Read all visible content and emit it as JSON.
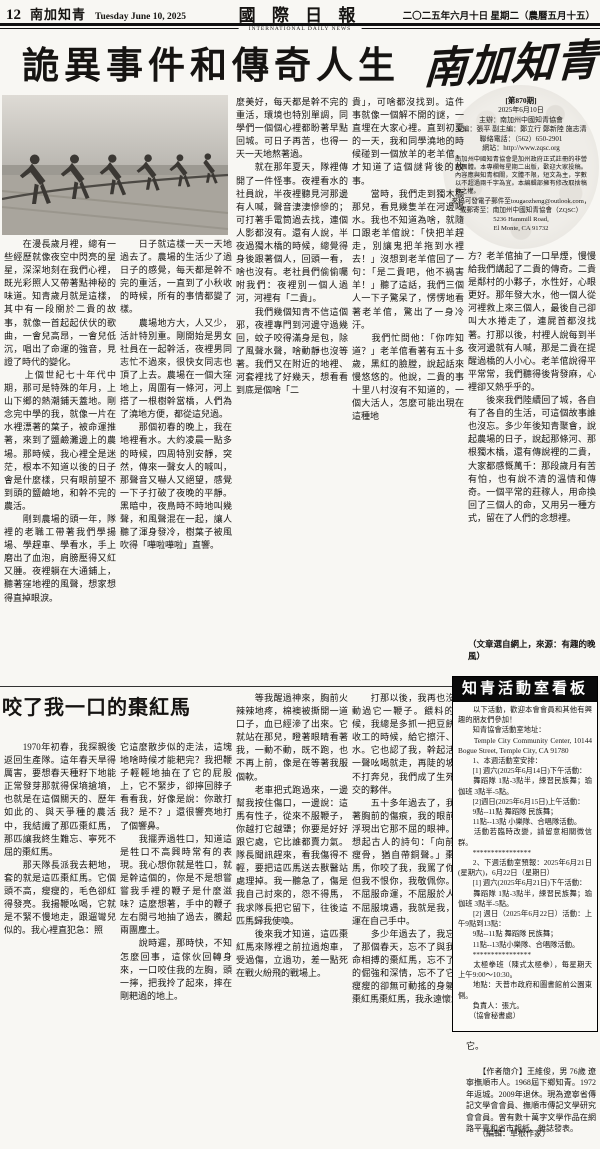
{
  "colors": {
    "ink": "#161412",
    "paper": "#f8f7f3",
    "bar": "#0a0a0a"
  },
  "header": {
    "page_number": "12",
    "section": "南加知青",
    "date_en": "Tuesday June 10, 2025",
    "paper_name": "國 際 日 報",
    "paper_sub": "INTERNATIONAL DAILY NEWS",
    "date_zh": "二〇二五年六月十日 星期二（農曆五月十五）"
  },
  "masthead": {
    "title": "南加知青"
  },
  "info_box": {
    "issue": "[第870期]",
    "date": "2025年6月10日",
    "host": "主辦：南加州中國知青協會",
    "editors": "主編：張平 副主編：鄭立行 鄭新陸 施志清",
    "phone": "聯絡電話：（562）650-2901",
    "site": "網站：http://www.zqsc.org",
    "notice": "南加州中國知青協會是加州政府正式註冊的非營利團體。本專欄每星期二出版，歡迎大家投稿。內容應與知青相關，文體不限，短文為主，字數以不超過兩千字為宜。本編輯部擁有修改取捨稿件之權。",
    "submit": "來稿可發電子郵件至tougaozheng@outlook.com，",
    "mail": "或郵寄至：南加州中國知青協會（ZQSC）",
    "addr1": "5236 Hammill Road,",
    "addr2": "El Monte,  CA 91732"
  },
  "main_article": {
    "title": "詭異事件和傳奇人生",
    "col1": "　　在漫長歲月裡，總有一些經歷就像夜空中閃亮的星星，深深地刻在我們心裡，既光彩照人又帶著點神秘的味道。知青歲月就是這樣，其中有一段關於二貴的故事，就像一首起起伏伏的歌曲，一會兒高昂，一會兒低沉，唱出了命運的強音，見證了時代的變化。\n　　上個世紀七十年代中期，那可是特殊的年月，上山下鄉的熱潮鋪天蓋地。剛念完中學的我，就像一片在水裡漂著的葉子，被命運推著，來到了鹽鹼灘邊上的農場。那時候，我心裡全是迷茫，根本不知道以後的日子會是什麼樣，只有眼前望不到頭的鹽鹼地，和幹不完的農活。\n　　剛到農場的頭一年，隊裡的老職工帶著我們學揚場、學趕車、學看水，手上磨出了血泡，肩膀壓得又紅又腫。夜裡躺在大通鋪上，聽著窪地裡的風聲，想家想得直掉眼淚。",
    "col2": "　　日子就這樣一天一天地過去了。農場的生活少了過日子的感覺，每天都是幹不完的重活，一直到了小秋收的時候，所有的事情都變了樣。\n　　農場地方大，人又少，活計特別重。剛開始是男女社員在一起幹活，夜裡男同志忙不過來，很快女同志也頂了上去。農場在一個大窪地上，周圍有一條河，河上搭了一根樹幹當橋，人們為了澆地方便，都從這兒過。\n　　那個初春的晚上，我在地裡看水。大約凌晨一點多的時候，四周特別安靜，突然，傳來一聲女人的喊叫，那聲音又嚇人又絕望，感覺一下子打破了夜晚的平靜。黑暗中，夜鳥時不時地叫幾聲，和風聲混在一起，讓人聽了渾身發冷，樹葉子被風吹得「嘩啦嘩啦」直響。",
    "col3": "麼美好，每天都是幹不完的重活，環境也特別單調，同學們一個個心裡都盼著早點回城。可日子再苦，也得一天一天地熬著過。\n　　就在那年夏天，隊裡傳開了一件怪事。夜裡看水的社員說，半夜裡聽見河那邊有人喊，聲音淒淒慘慘的；可打著手電筒過去找，連個人影都沒有。還有人說，半夜過獨木橋的時候，總覺得身後跟著個人，回頭一看，啥也沒有。老社員們偷偷囑咐我們：夜裡別一個人過河，河裡有「二貴」。\n　　我們幾個知青不信這個邪，夜裡專門到河邊守過幾回，蚊子咬得滿身是包，除了風聲水聲，啥動靜也沒等著。我們又在附近的地裡、河套裡找了好幾天，想看看到底是個啥「二",
    "col4": "貴」，可啥都沒找到。這件事就像一個解不開的謎，一直埋在大家心裡。直到初夏的一天，我和同學澆地的時候碰到一個放羊的老羊倌，才知道了這個謎背後的故事。\n　　當時，我們走到獨木橋那兒，看見幾隻羊在河邊喝水。我也不知道為啥，就隨口跟老羊倌說：「快把羊趕走，別讓鬼把羊拖到水裡去！」沒想到老羊倌回了一句：「是二貴吧，他不禍害羊！」聽了這話，我們三個人一下子驚呆了，愣愣地看著老羊倌，驚出了一身冷汗。\n　　我們忙問他：「你咋知道？」老羊倌看著有五十多歲，黑紅的臉膛，說起話來慢悠悠的。他說，二貴的事十里八村沒有不知道的，一個大活人，怎麼可能出現在這種地",
    "col5": "方？老羊倌抽了一口旱煙，慢慢給我們講起了二貴的傳奇。二貴是鄰村的小夥子，水性好，心眼更好。那年發大水，他一個人從河裡救上來三個人，最後自己卻叫大水捲走了，連屍首都沒找著。打那以後，村裡人說每到半夜河邊就有人喊，那是二貴在提醒過橋的人小心。老羊倌說得平平常常，我們聽得後背發麻，心裡卻又熱乎乎的。\n　　後來我們陸續回了城，各自有了各自的生活，可這個故事誰也沒忘。多少年後知青聚會，說起農場的日子，說起那條河、那根獨木橋，還有傳說裡的二貴，大家都感慨萬千：那段歲月有苦有怕，也有說不清的溫情和傳奇。一個平常的莊稼人，用命換回了三個人的命，又用另一種方式，留在了人們的念想裡。",
    "source": "（文章選自網上，來源：有趣的晚風）"
  },
  "article2": {
    "title": "咬了我一口的棗紅馬",
    "col1": "　　1970年初春，我探親後返回生產隊。這年春天旱得厲害，要想春天種籽下地能正常發芽那就得保墒搶墒，也就是在這個關天的、歷年如此的、與天爭種的農活中，我結識了那匹棗紅馬，那匹讓我終生難忘、寧死不屈的棗紅馬。\n　　那天隊長派我去耙地，套的就是這匹棗紅馬。它個頭不高，瘦瘦的，毛色卻紅得發亮。我揚鞭吆喝，它就是不緊不慢地走，跟遛彎兒似的。我心裡直犯急：照",
    "col2": "它這麼散步似的走法，這塊地啥時候才能耙完？我把鞭子輕輕地抽在了它的屁股上，它不緊步，卻擰回脖子看看我，好像是說：你敢打我？是不？」還很響亮地打了個響鼻。\n　　我擺弄過牲口，知道這是牲口不高興時常有的表現。我心想你就是牲口，就是幹這個的，你是不是想嘗嘗我手裡的鞭子是什麼滋味？這麼想著，手中的鞭子左右開弓地抽了過去，騰起兩團塵土。\n　　說時遲，那時快，不知怎麼回事，這傢伙回轉身來，一口咬住我的左胸，頭一擰，把我拎了起來，摔在剛耙過的地上。",
    "col3": "　　等我醒過神來，胸前火辣辣地疼，棉襖被撕開一道口子，血已經滲了出來。它就站在那兒，瞪著眼睛看著我，一動不動，既不跑，也不再上前，像是在等著我服個軟。\n　　老車把式跑過來，一邊幫我按住傷口，一邊說：這馬有性子，從來不服鞭子，你越打它越犟；你要是好好跟它處，它比誰都賣力氣。隊長聞訊趕來，看我傷得不輕，要把這匹馬送去獸醫站處理掉。我一聽急了，傷是我自己討來的，怨不得馬，我求隊長把它留下，往後這匹馬歸我使喚。\n　　後來我才知道，這匹棗紅馬來隊裡之前拉過炮車，受過傷，立過功，差一點死在戰火紛飛的戰場上。",
    "col4": "　　打那以後，我再也沒有動過它一鞭子。餵料的時候，我總是多抓一把豆餅；收工的時候，給它擦汗、飲水。它也認了我，幹起活來一聲吆喝就走，再陡的坡也不打奔兒，我們成了生死之交的夥伴。\n　　五十多年過去了，我看著胸前的傷痕，我的眼前又浮現出它那不屈的眼神。我想起古人的詩句：「向前敲瘦骨，猶自帶銅聲。」棗紅馬，你咬了我，我罵了你，但我不恨你，我敬佩你。你不屈服命運，不屈服於人，不屈服境遇，我就是我，命運在自己手中。\n　　多少年過去了，我忘不了那個春天，忘不了與我以命相搏的棗紅馬，忘不了它的倔強和深情，忘不了它那瘦瘦的卻無可動搖的身軀。棗紅馬棗紅馬，我永遠懷念",
    "tail": "它。",
    "bio": "　　【作者簡介】王維俊，男 76歲 遼寧撫順市人。1968屆下鄉知青。1972年返城。2009年退休。現為遼寧省傳記文學會會員、撫順市傳記文學研究會會員。曾有數十萬字文學作品在網路平臺和省市報紙、雜誌發表。",
    "editor": "　　（編輯：草根作家）"
  },
  "activity_board": {
    "title": "知青活動室看板",
    "body": "　　以下活動，歡迎本會會員和其他有興趣的朋友們參加！\n　　知青協會活動室地址：\n　　Temple City Community Center, 10144 Bogue Street, Temple City, CA 91780\n　　1、本週活動室安排：\n　　[1] 週六(2025年6月14日)下午活動：\n　　舞蹈隊 1點-3點半，練習民族舞；瑜伽班 3點半-5點。\n　　[2]週日(2025年6月15日)上午活動：\n　　9點--11點 舞蹈隊 民族舞；\n　　11點--13點 小樂隊、合唱隊活動。\n　　活動若臨時改變，請留意相關微信群。\n　　****************\n　　2、下週活動室預報：2025年6月21日(星期六)，6月22日（星期日）\n　　[1] 週六(2025年6月21日)下午活動：\n　　舞蹈隊 1點-3點半，練習民族舞；瑜伽班 3點半-5點。\n　　[2] 週日（2025年6月22日）活動：上午9點到13點：\n　　9點--11點 舞蹈隊 民族舞；\n　　11點--13點小樂隊、合唱隊活動。\n　　****************\n　　太極拳班（陳式太極拳），每星期天上午9:00～10:30。\n　　地點：天普市政府和圖書館前公園東側。\n　　負責人：張亢。\n　　（協會秘書處）"
  }
}
